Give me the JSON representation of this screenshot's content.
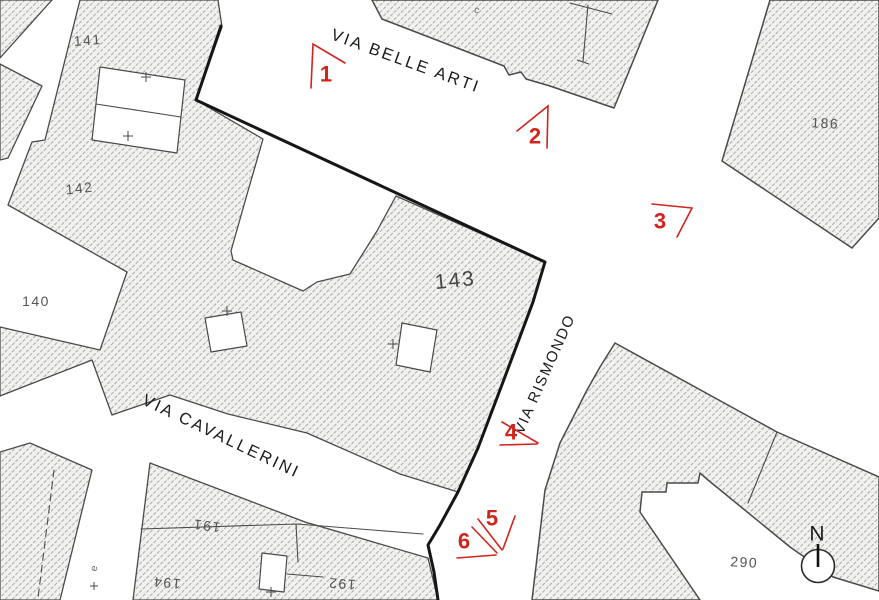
{
  "map": {
    "streets": {
      "belle_arti": "VIA BELLE ARTI",
      "rismondo": "VIA RISMONDO",
      "cavallerini": "VIA CAVALLERINI"
    },
    "parcels": {
      "p141": "141",
      "p142": "142",
      "p140": "140",
      "p143": "143",
      "p186": "186",
      "p191": "191",
      "p194": "194",
      "p192": "192",
      "p290": "290"
    },
    "small_labels": {
      "building_letter": "c",
      "edge_partial": "e"
    },
    "markers": {
      "m1": "1",
      "m2": "2",
      "m3": "3",
      "m4": "4",
      "m5": "5",
      "m6": "6"
    },
    "north": {
      "label": "N"
    },
    "colors": {
      "marker_red": "#d0241c",
      "hatch_fill": "#f1f1ef",
      "hatch_line": "#aaaaa8",
      "outline": "#4a4a48",
      "thick_boundary": "#161616",
      "label_gray": "#555553"
    }
  }
}
